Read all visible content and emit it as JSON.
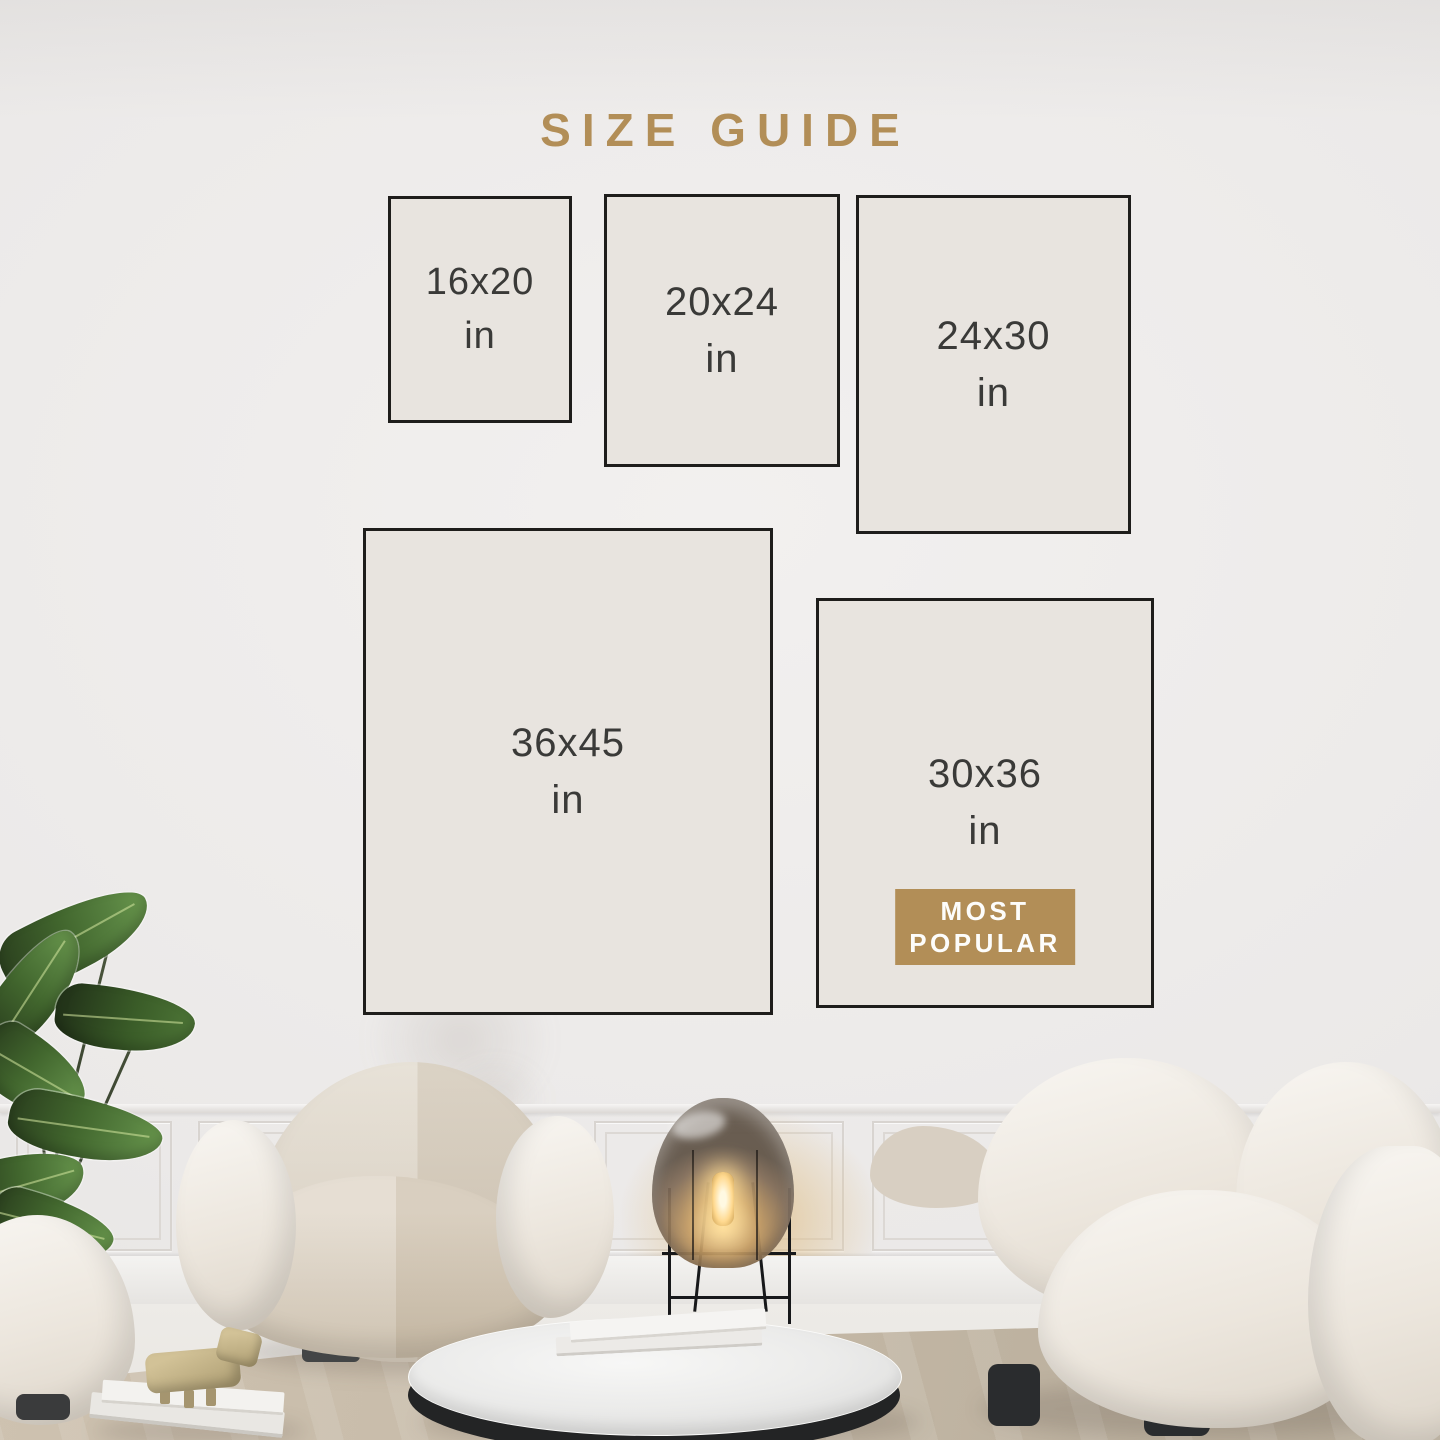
{
  "title": {
    "label": "SIZE GUIDE"
  },
  "size_boxes": [
    {
      "id": "16x20",
      "label": "16x20",
      "unit": "in",
      "most_popular": false
    },
    {
      "id": "20x24",
      "label": "20x24",
      "unit": "in",
      "most_popular": false
    },
    {
      "id": "24x30",
      "label": "24x30",
      "unit": "in",
      "most_popular": false
    },
    {
      "id": "36x45",
      "label": "36x45",
      "unit": "in",
      "most_popular": false
    },
    {
      "id": "30x36",
      "label": "30x36",
      "unit": "in",
      "most_popular": true
    }
  ],
  "badge": {
    "line1": "MOST",
    "line2": "POPULAR"
  },
  "colors": {
    "accent_gold": "#b28e57",
    "box_fill": "#e8e4df",
    "box_border": "#1e1d1b",
    "label_text": "#3a3a38",
    "badge_text": "#fdfdfb",
    "wall": "#ebe9e8",
    "rug": "#c6baa8"
  },
  "scene": {
    "objects": [
      "potted-plant",
      "pouf",
      "armchair",
      "glass-floor-lamp",
      "marble-coffee-table",
      "books-on-table",
      "books-on-floor",
      "wooden-toy-figure",
      "sofa",
      "area-rug",
      "wainscot-panels"
    ]
  }
}
